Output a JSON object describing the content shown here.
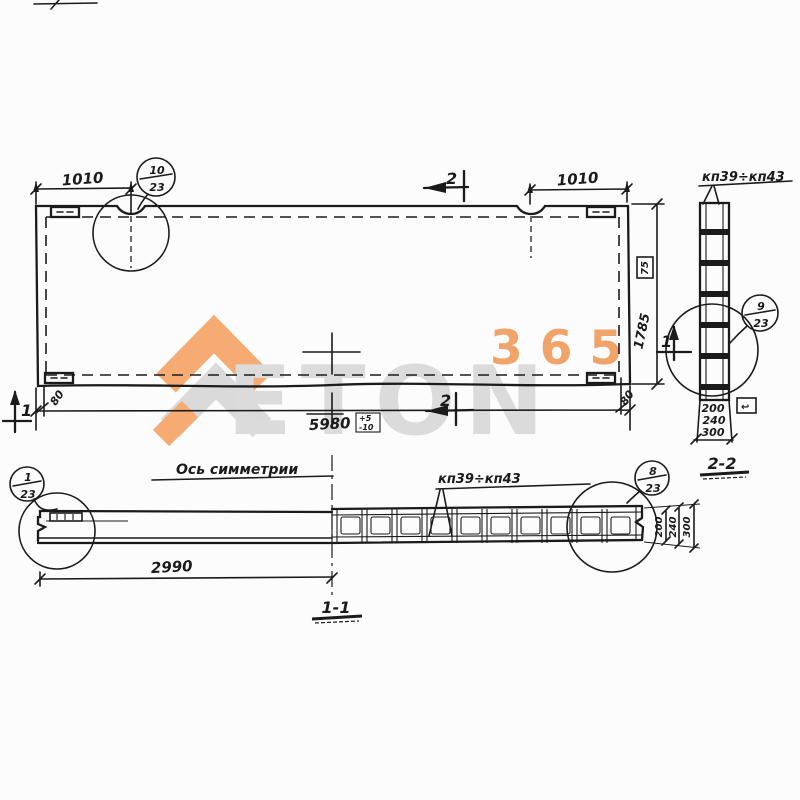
{
  "watermark": {
    "digits": "365",
    "word": "ETON",
    "orange": "#f2a469",
    "gray": "#dbdbdb"
  },
  "plan": {
    "dim_left": "1010",
    "dim_right": "1010",
    "dim_length": "5980",
    "dim_height": "1785",
    "dim_edge_left": "80",
    "dim_edge_right": "80",
    "tol_plus": "+5",
    "tol_minus": "-10",
    "marker_box": "75",
    "callout_top": {
      "num": "10",
      "den": "23"
    },
    "section2_top": "2",
    "section2_bottom": "2",
    "section1_left": "1",
    "section1_right": "1"
  },
  "section22": {
    "label": "2-2",
    "part_label": "кп39÷кп43",
    "callout": {
      "num": "9",
      "den": "23"
    },
    "dims": [
      "200",
      "240",
      "300"
    ],
    "marker_arrow": "↩"
  },
  "section11": {
    "label": "1-1",
    "axis_label": "Ось симметрии",
    "part_label": "кп39÷кп43",
    "dim_half": "2990",
    "callout_left": {
      "num": "1",
      "den": "23"
    },
    "callout_right": {
      "num": "8",
      "den": "23"
    },
    "dims": [
      "200",
      "240",
      "300"
    ]
  }
}
